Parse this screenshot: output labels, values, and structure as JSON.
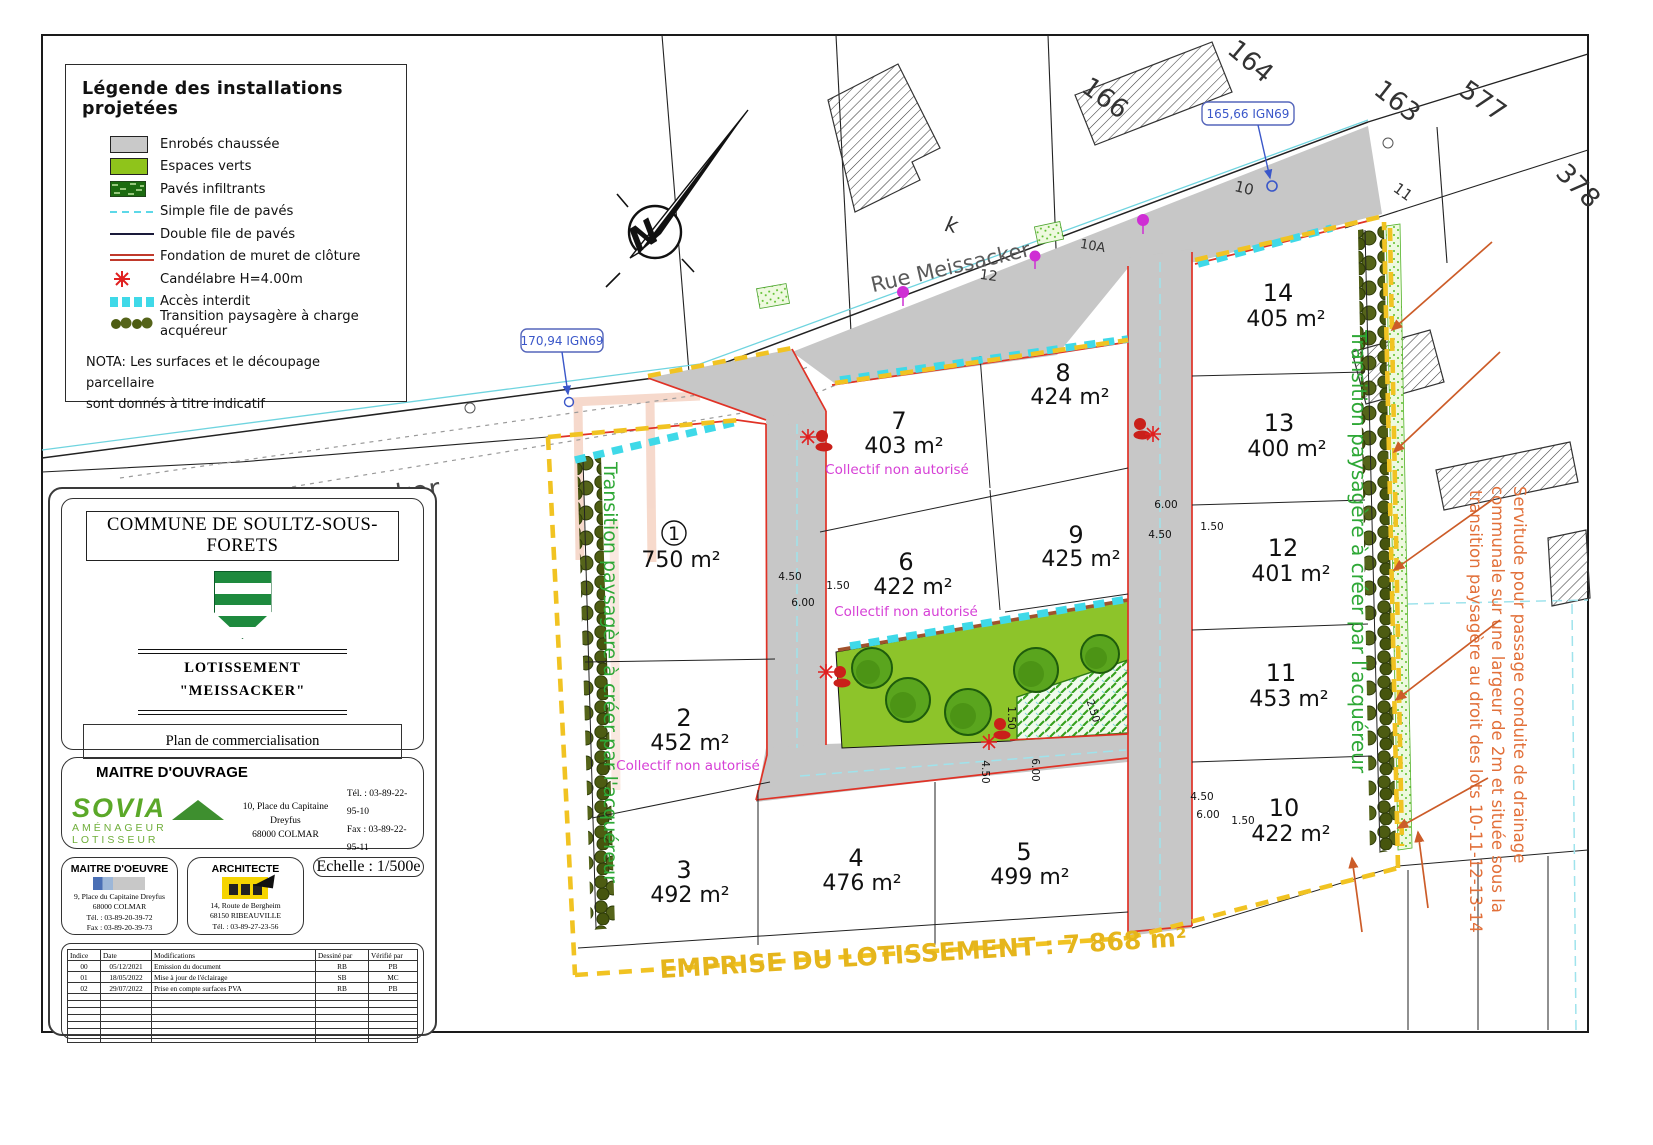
{
  "legend": {
    "title": "Légende des installations projetées",
    "items": [
      {
        "icon": "swatch-gray",
        "label": "Enrobés chaussée"
      },
      {
        "icon": "swatch-green",
        "label": "Espaces verts"
      },
      {
        "icon": "swatch-pavers",
        "label": "Pavés infiltrants"
      },
      {
        "icon": "cyan-dashed-line",
        "label": "Simple file de pavés"
      },
      {
        "icon": "dark-line",
        "label": "Double file de pavés"
      },
      {
        "icon": "double-red-line",
        "label": "Fondation de muret de clôture"
      },
      {
        "icon": "red-star",
        "label": "Candélabre H=4.00m"
      },
      {
        "icon": "cyan-dash-squares",
        "label": "Accès interdit"
      },
      {
        "icon": "tree-row",
        "label": "Transition paysagère à charge acquéreur"
      }
    ],
    "nota_line1": "NOTA: Les surfaces et le découpage parcellaire",
    "nota_line2": "sont donnés à titre indicatif"
  },
  "title_block": {
    "commune": "COMMUNE DE SOULTZ-SOUS-FORETS",
    "project_type": "LOTISSEMENT",
    "project_name": "\"MEISSACKER\"",
    "doc_title": "Plan de commercialisation",
    "maitre_ouvrage": {
      "heading": "MAITRE D'OUVRAGE",
      "company": "SOVIA",
      "tagline": "AMÉNAGEUR  LOTISSEUR",
      "address_line1": "10, Place du Capitaine Dreyfus",
      "address_line2": "68000 COLMAR",
      "tel": "Tél. : 03-89-22-95-10",
      "fax": "Fax : 03-89-22-95-11"
    },
    "maitre_oeuvre": {
      "heading": "MAITRE D'OEUVRE",
      "address_line1": "9, Place du Capitaine Dreyfus",
      "address_line2": "68000  COLMAR",
      "tel": "Tél. : 03-89-20-39-72",
      "fax": "Fax : 03-89-20-39-73"
    },
    "architecte": {
      "heading": "ARCHITECTE",
      "address_line1": "14, Route de Bergheim",
      "address_line2": "68150 RIBEAUVILLE",
      "tel": "Tél. : 03-89-27-23-56"
    },
    "echelle": "Echelle : 1/500e",
    "revisions": {
      "headers": [
        "Indice",
        "Date",
        "Modifications",
        "Dessiné par",
        "Vérifié par"
      ],
      "rows": [
        [
          "00",
          "05/12/2021",
          "Emission du document",
          "RB",
          "PB"
        ],
        [
          "01",
          "18/05/2022",
          "Mise à jour de l'éclairage",
          "SB",
          "MC"
        ],
        [
          "02",
          "29/07/2022",
          "Prise en compte surfaces PVA",
          "RB",
          "PB"
        ]
      ]
    }
  },
  "plan": {
    "street_name": "Rue Meissacker",
    "north": "N",
    "elev1": "170,94 IGN69",
    "elev2": "165,66 IGN69",
    "emprise": "EMPRISE DU LOTISSEMENT : 7 868 m²",
    "collectif": "Collectif non autorisé",
    "transition": "Transition paysagère à créer par l'acquéreur",
    "servitude1": "Servitude pour passage conduite de drainage",
    "servitude2": "communale sur une largeur de 2m et située sous la",
    "servitude3": "transition paysagère au droit des lots 10-11-12-13-14",
    "lots": [
      {
        "num": "1",
        "area": "750 m²"
      },
      {
        "num": "2",
        "area": "452 m²"
      },
      {
        "num": "3",
        "area": "492 m²"
      },
      {
        "num": "4",
        "area": "476 m²"
      },
      {
        "num": "5",
        "area": "499 m²"
      },
      {
        "num": "6",
        "area": "422 m²"
      },
      {
        "num": "7",
        "area": "403 m²"
      },
      {
        "num": "8",
        "area": "424 m²"
      },
      {
        "num": "9",
        "area": "425 m²"
      },
      {
        "num": "10",
        "area": "422 m²"
      },
      {
        "num": "11",
        "area": "453 m²"
      },
      {
        "num": "12",
        "area": "401 m²"
      },
      {
        "num": "13",
        "area": "400 m²"
      },
      {
        "num": "14",
        "area": "405 m²"
      }
    ],
    "cadastre": [
      "164",
      "166",
      "k",
      "163",
      "577",
      "378",
      "10",
      "10A",
      "12",
      "11"
    ],
    "dims": [
      "4.50",
      "1.50",
      "6.00",
      "6.00",
      "1.50",
      "4.50",
      "1.50",
      "4.50",
      "6.00",
      "2.50",
      "4.50",
      "6.00",
      "1.50"
    ]
  },
  "colors": {
    "road_gray": "#c7c7c7",
    "green_space": "#8dc42a",
    "emprise_yellow": "#f1c322",
    "access_cyan": "#3fd9e8",
    "road_edge_red": "#e03226",
    "collectif_magenta": "#d63fd6",
    "transition_green": "#2ea836",
    "servitude_orange": "#e2703a",
    "elevation_blue": "#3a57c9"
  }
}
